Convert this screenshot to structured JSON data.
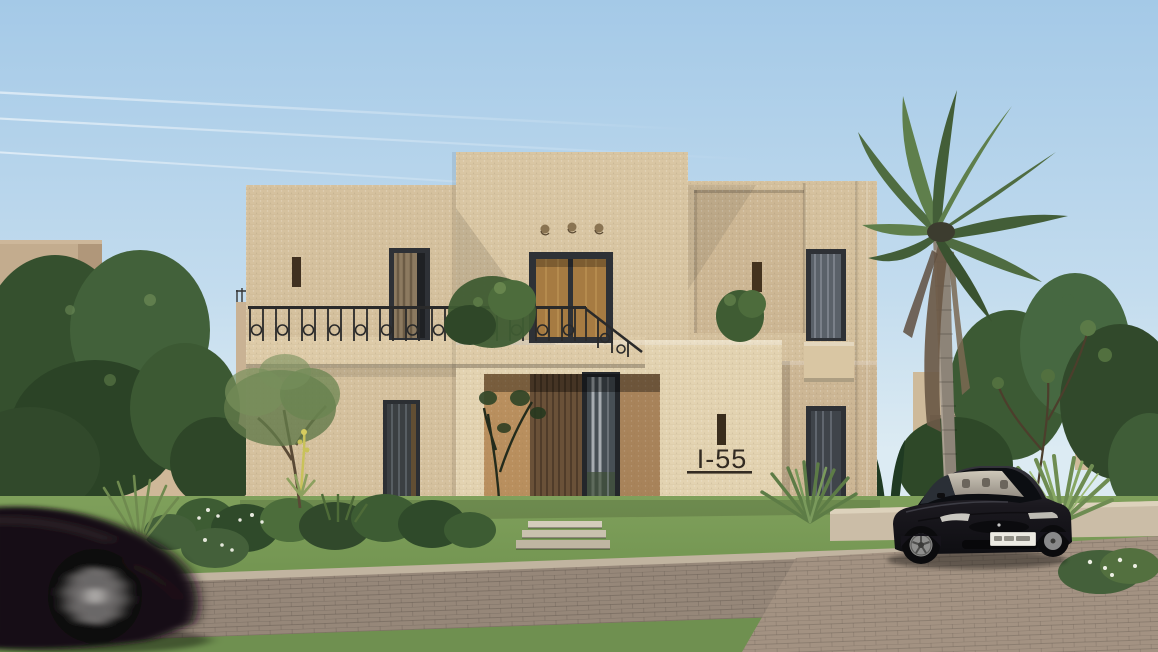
{
  "house": {
    "number": "I-55"
  },
  "colors": {
    "sky_top": "#A4C9E7",
    "sky_horizon": "#DCEBF3",
    "wall": "#D5C19E",
    "wall_light": "#E3D3B1",
    "wall_shadow": "#C2AC89",
    "window_frame": "#2E3136",
    "glass_amber": "#A67B42",
    "wood_door": "#6A5138",
    "porch_shadow": "#3A2C1E",
    "iron_railing": "#2A2A2A",
    "grass": "#6F9050",
    "foliage_dark": "#31492B",
    "foliage_light": "#5F7F4C",
    "palm_green": "#4F6C41",
    "palm_trunk": "#8D8478",
    "pavers": "#968779",
    "curb": "#C1B4A0",
    "car_black": "#17141B",
    "car_interior": "#D6CFBF",
    "number_text": "#332B22"
  }
}
